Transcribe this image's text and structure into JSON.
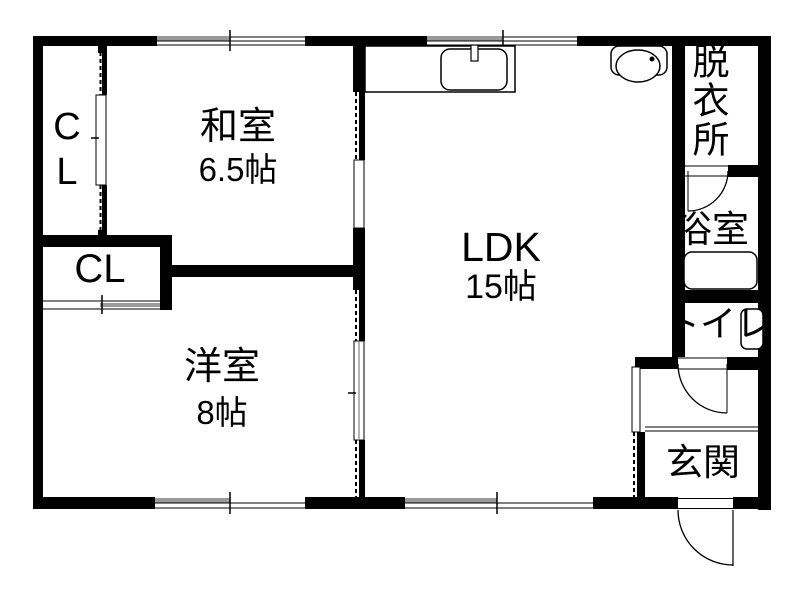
{
  "rooms": {
    "washitsu": {
      "name": "和室",
      "size": "6.5帖"
    },
    "closet_upper": {
      "name": "CL"
    },
    "closet_lower": {
      "name": "CL"
    },
    "yoshitsu": {
      "name": "洋室",
      "size": "8帖"
    },
    "ldk": {
      "name": "LDK",
      "size": "15帖"
    },
    "datsuijo": {
      "name": "脱衣所"
    },
    "yokushitsu": {
      "name": "浴室"
    },
    "toire": {
      "name": "トイレ"
    },
    "genkan": {
      "name": "玄関"
    }
  },
  "colors": {
    "wall": "#000000",
    "background": "#ffffff",
    "window_frame": "#9a9a9a"
  }
}
